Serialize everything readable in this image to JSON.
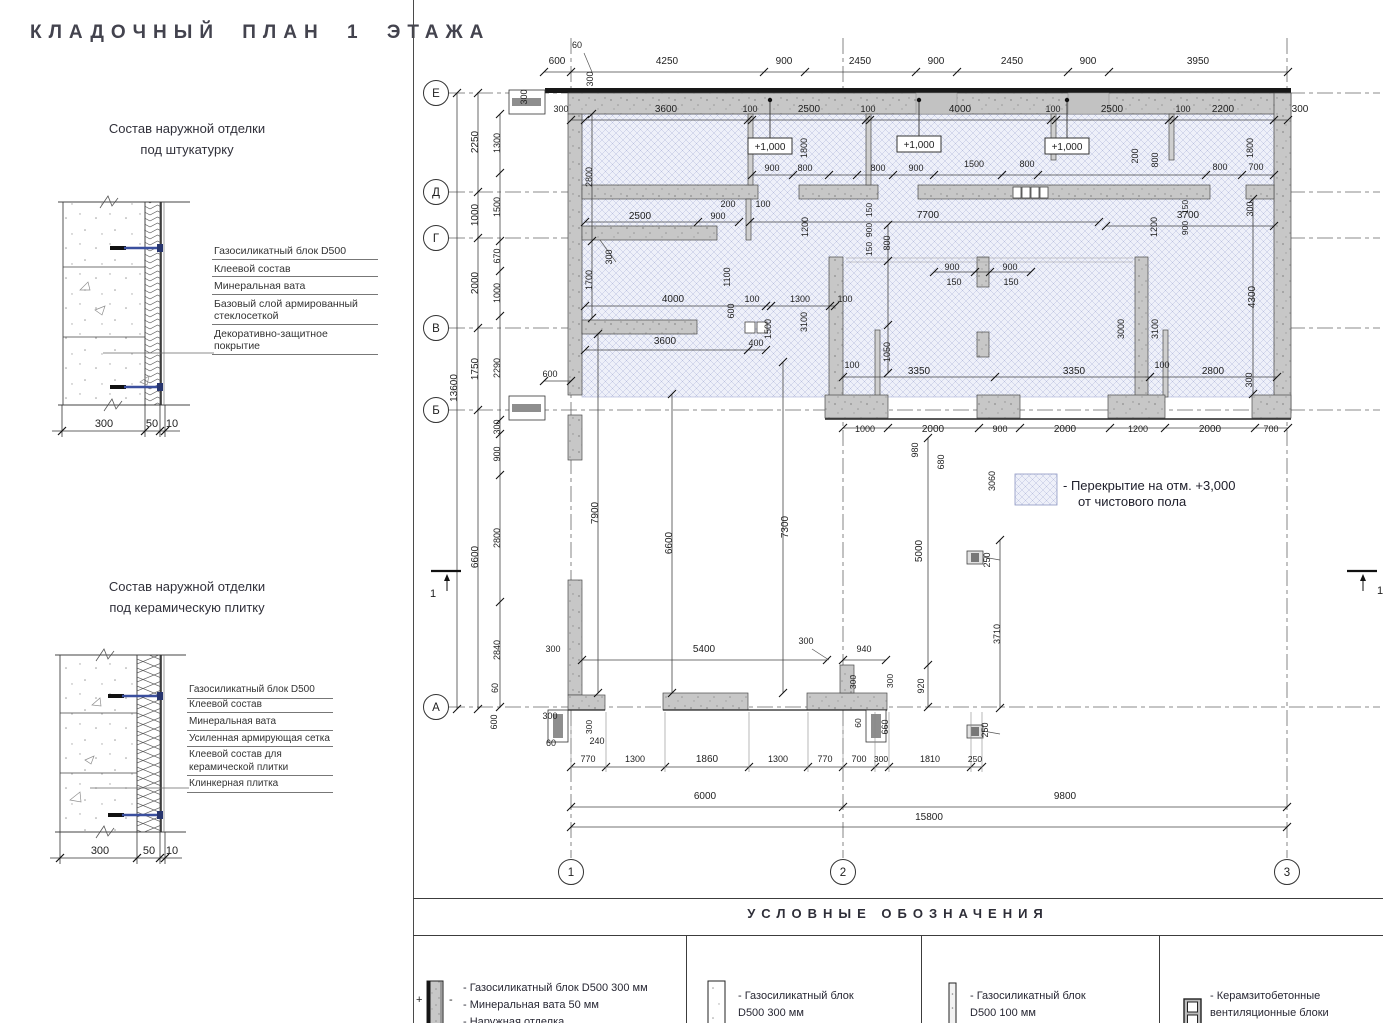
{
  "page": {
    "title": "КЛАДОЧНЫЙ ПЛАН 1 ЭТАЖА"
  },
  "details": [
    {
      "title_line1": "Состав наружной отделки",
      "title_line2": "под штукатурку",
      "labels": [
        "Газосиликатный блок D500",
        "Клеевой состав",
        "Минеральная вата",
        "Базовый слой армированный стеклосеткой",
        "Декоративно-защитное покрытие"
      ],
      "dims": [
        "300",
        "50",
        "10"
      ]
    },
    {
      "title_line1": "Состав наружной отделки",
      "title_line2": "под керамическую плитку",
      "labels": [
        "Газосиликатный блок D500",
        "Клеевой состав",
        "Минеральная вата",
        "Усиленная армирующая сетка",
        "Клеевой состав для керамической плитки",
        "Клинкерная плитка"
      ],
      "dims": [
        "300",
        "50",
        "10"
      ]
    }
  ],
  "plan": {
    "axes": {
      "rows": [
        {
          "label": "Е",
          "y": 93
        },
        {
          "label": "Д",
          "y": 192
        },
        {
          "label": "Г",
          "y": 238
        },
        {
          "label": "В",
          "y": 328
        },
        {
          "label": "Б",
          "y": 410
        },
        {
          "label": "А",
          "y": 707
        }
      ],
      "cols": [
        {
          "label": "1",
          "x": 571
        },
        {
          "label": "2",
          "x": 843
        },
        {
          "label": "3",
          "x": 1287
        }
      ]
    },
    "elevation_markers": [
      {
        "text": "+1,000",
        "x": 748,
        "y": 138
      },
      {
        "text": "+1,000",
        "x": 897,
        "y": 136
      },
      {
        "text": "+1,000",
        "x": 1045,
        "y": 138
      }
    ],
    "section_marks": [
      {
        "label": "1",
        "x": 431,
        "y": 571,
        "lx": 433,
        "ly": 597
      },
      {
        "label": "1",
        "x": 1347,
        "y": 571,
        "lx": 1380,
        "ly": 594
      }
    ],
    "floor_note": {
      "line1": "- Перекрытие на отм. +3,000",
      "line2": "от чистового пола"
    },
    "dim_labels": [
      {
        "t": "600",
        "x": 557,
        "y": 64
      },
      {
        "t": "4250",
        "x": 667,
        "y": 64
      },
      {
        "t": "900",
        "x": 784,
        "y": 64
      },
      {
        "t": "2450",
        "x": 860,
        "y": 64
      },
      {
        "t": "900",
        "x": 936,
        "y": 64
      },
      {
        "t": "2450",
        "x": 1012,
        "y": 64
      },
      {
        "t": "900",
        "x": 1088,
        "y": 64
      },
      {
        "t": "3950",
        "x": 1198,
        "y": 64
      },
      {
        "t": "60",
        "x": 577,
        "y": 48,
        "fs": 9
      },
      {
        "t": "300",
        "x": 561,
        "y": 112,
        "fs": 9
      },
      {
        "t": "3600",
        "x": 666,
        "y": 112
      },
      {
        "t": "100",
        "x": 750,
        "y": 112,
        "fs": 9
      },
      {
        "t": "2500",
        "x": 809,
        "y": 112
      },
      {
        "t": "100",
        "x": 868,
        "y": 112,
        "fs": 9
      },
      {
        "t": "4000",
        "x": 960,
        "y": 112
      },
      {
        "t": "100",
        "x": 1053,
        "y": 112,
        "fs": 9
      },
      {
        "t": "2500",
        "x": 1112,
        "y": 112
      },
      {
        "t": "100",
        "x": 1183,
        "y": 112,
        "fs": 9
      },
      {
        "t": "2200",
        "x": 1223,
        "y": 112
      },
      {
        "t": "300",
        "x": 1300,
        "y": 112
      },
      {
        "t": "300",
        "x": 527,
        "y": 97,
        "r": 1,
        "fs": 9
      },
      {
        "t": "300",
        "x": 593,
        "y": 79,
        "r": 1,
        "fs": 9
      },
      {
        "t": "13600",
        "x": 457,
        "y": 388,
        "r": 1
      },
      {
        "t": "2250",
        "x": 478,
        "y": 142,
        "r": 1
      },
      {
        "t": "1000",
        "x": 478,
        "y": 215,
        "r": 1
      },
      {
        "t": "2000",
        "x": 478,
        "y": 283,
        "r": 1
      },
      {
        "t": "1750",
        "x": 478,
        "y": 369,
        "r": 1
      },
      {
        "t": "6600",
        "x": 478,
        "y": 557,
        "r": 1
      },
      {
        "t": "1300",
        "x": 500,
        "y": 143,
        "r": 1,
        "fs": 9
      },
      {
        "t": "1500",
        "x": 500,
        "y": 207,
        "r": 1,
        "fs": 9
      },
      {
        "t": "670",
        "x": 500,
        "y": 256,
        "r": 1,
        "fs": 9
      },
      {
        "t": "1000",
        "x": 500,
        "y": 293,
        "r": 1,
        "fs": 9
      },
      {
        "t": "2290",
        "x": 500,
        "y": 368,
        "r": 1,
        "fs": 9
      },
      {
        "t": "300",
        "x": 500,
        "y": 427,
        "r": 1,
        "fs": 9
      },
      {
        "t": "900",
        "x": 500,
        "y": 454,
        "r": 1,
        "fs": 9
      },
      {
        "t": "2800",
        "x": 500,
        "y": 538,
        "r": 1,
        "fs": 9
      },
      {
        "t": "2840",
        "x": 500,
        "y": 650,
        "r": 1,
        "fs": 9
      },
      {
        "t": "60",
        "x": 498,
        "y": 688,
        "r": 1,
        "fs": 9
      },
      {
        "t": "600",
        "x": 497,
        "y": 722,
        "r": 1,
        "fs": 9
      },
      {
        "t": "2800",
        "x": 592,
        "y": 177,
        "r": 1,
        "fs": 9
      },
      {
        "t": "1700",
        "x": 592,
        "y": 280,
        "r": 1,
        "fs": 9
      },
      {
        "t": "1800",
        "x": 807,
        "y": 148,
        "r": 1,
        "fs": 9
      },
      {
        "t": "1800",
        "x": 1253,
        "y": 148,
        "r": 1,
        "fs": 9
      },
      {
        "t": "200",
        "x": 1138,
        "y": 156,
        "r": 1,
        "fs": 9
      },
      {
        "t": "800",
        "x": 1158,
        "y": 160,
        "r": 1,
        "fs": 9
      },
      {
        "t": "900",
        "x": 772,
        "y": 171,
        "fs": 9
      },
      {
        "t": "800",
        "x": 805,
        "y": 171,
        "fs": 9
      },
      {
        "t": "800",
        "x": 878,
        "y": 171,
        "fs": 9
      },
      {
        "t": "900",
        "x": 916,
        "y": 171,
        "fs": 9
      },
      {
        "t": "1500",
        "x": 974,
        "y": 167,
        "fs": 9
      },
      {
        "t": "800",
        "x": 1027,
        "y": 167,
        "fs": 9
      },
      {
        "t": "800",
        "x": 1220,
        "y": 170,
        "fs": 9
      },
      {
        "t": "700",
        "x": 1256,
        "y": 170,
        "fs": 9
      },
      {
        "t": "150",
        "x": 872,
        "y": 210,
        "r": 1,
        "fs": 8.5
      },
      {
        "t": "900",
        "x": 872,
        "y": 230,
        "r": 1,
        "fs": 8.5
      },
      {
        "t": "150",
        "x": 872,
        "y": 249,
        "r": 1,
        "fs": 8.5
      },
      {
        "t": "150",
        "x": 1188,
        "y": 207,
        "r": 1,
        "fs": 8.5
      },
      {
        "t": "900",
        "x": 1188,
        "y": 228,
        "r": 1,
        "fs": 8.5
      },
      {
        "t": "200",
        "x": 728,
        "y": 207,
        "fs": 9
      },
      {
        "t": "100",
        "x": 763,
        "y": 207,
        "fs": 9
      },
      {
        "t": "2500",
        "x": 640,
        "y": 219
      },
      {
        "t": "900",
        "x": 718,
        "y": 219,
        "fs": 9
      },
      {
        "t": "7700",
        "x": 928,
        "y": 218
      },
      {
        "t": "3700",
        "x": 1188,
        "y": 218
      },
      {
        "t": "300",
        "x": 1253,
        "y": 209,
        "r": 1,
        "fs": 9
      },
      {
        "t": "1200",
        "x": 1157,
        "y": 227,
        "r": 1,
        "fs": 9
      },
      {
        "t": "1200",
        "x": 808,
        "y": 227,
        "r": 1,
        "fs": 9
      },
      {
        "t": "1100",
        "x": 730,
        "y": 277,
        "r": 1,
        "fs": 9
      },
      {
        "t": "300",
        "x": 612,
        "y": 257,
        "r": 1,
        "fs": 9
      },
      {
        "t": "4000",
        "x": 673,
        "y": 302
      },
      {
        "t": "100",
        "x": 752,
        "y": 302,
        "fs": 9
      },
      {
        "t": "1300",
        "x": 800,
        "y": 302,
        "fs": 9
      },
      {
        "t": "100",
        "x": 845,
        "y": 302,
        "fs": 9
      },
      {
        "t": "600",
        "x": 734,
        "y": 311,
        "r": 1,
        "fs": 9
      },
      {
        "t": "1500",
        "x": 771,
        "y": 329,
        "r": 1,
        "fs": 9
      },
      {
        "t": "3100",
        "x": 807,
        "y": 322,
        "r": 1,
        "fs": 9
      },
      {
        "t": "3600",
        "x": 665,
        "y": 344
      },
      {
        "t": "400",
        "x": 756,
        "y": 346,
        "fs": 9
      },
      {
        "t": "800",
        "x": 890,
        "y": 243,
        "r": 1,
        "fs": 9
      },
      {
        "t": "1050",
        "x": 890,
        "y": 352,
        "r": 1,
        "fs": 9
      },
      {
        "t": "900",
        "x": 952,
        "y": 270,
        "fs": 9
      },
      {
        "t": "900",
        "x": 1010,
        "y": 270,
        "fs": 9
      },
      {
        "t": "150",
        "x": 954,
        "y": 285,
        "fs": 9
      },
      {
        "t": "150",
        "x": 1011,
        "y": 285,
        "fs": 9
      },
      {
        "t": "3000",
        "x": 1124,
        "y": 329,
        "r": 1,
        "fs": 9
      },
      {
        "t": "3100",
        "x": 1158,
        "y": 329,
        "r": 1,
        "fs": 9
      },
      {
        "t": "4300",
        "x": 1255,
        "y": 297,
        "r": 1
      },
      {
        "t": "100",
        "x": 852,
        "y": 368,
        "fs": 9
      },
      {
        "t": "3350",
        "x": 919,
        "y": 374
      },
      {
        "t": "3350",
        "x": 1074,
        "y": 374
      },
      {
        "t": "100",
        "x": 1162,
        "y": 368,
        "fs": 9
      },
      {
        "t": "2800",
        "x": 1213,
        "y": 374
      },
      {
        "t": "300",
        "x": 1252,
        "y": 380,
        "r": 1,
        "fs": 9
      },
      {
        "t": "600",
        "x": 550,
        "y": 377,
        "fs": 9
      },
      {
        "t": "1000",
        "x": 865,
        "y": 432,
        "fs": 9
      },
      {
        "t": "2000",
        "x": 933,
        "y": 432
      },
      {
        "t": "900",
        "x": 1000,
        "y": 432,
        "fs": 9
      },
      {
        "t": "2000",
        "x": 1065,
        "y": 432
      },
      {
        "t": "1200",
        "x": 1138,
        "y": 432,
        "fs": 9
      },
      {
        "t": "2000",
        "x": 1210,
        "y": 432
      },
      {
        "t": "700",
        "x": 1271,
        "y": 432,
        "fs": 9
      },
      {
        "t": "980",
        "x": 918,
        "y": 450,
        "r": 1,
        "fs": 9
      },
      {
        "t": "680",
        "x": 944,
        "y": 462,
        "r": 1,
        "fs": 9
      },
      {
        "t": "3060",
        "x": 995,
        "y": 481,
        "r": 1,
        "fs": 9
      },
      {
        "t": "7900",
        "x": 598,
        "y": 513,
        "r": 1
      },
      {
        "t": "6600",
        "x": 672,
        "y": 543,
        "r": 1
      },
      {
        "t": "7300",
        "x": 788,
        "y": 527,
        "r": 1
      },
      {
        "t": "5000",
        "x": 922,
        "y": 551,
        "r": 1
      },
      {
        "t": "3710",
        "x": 1000,
        "y": 634,
        "r": 1,
        "fs": 9
      },
      {
        "t": "920",
        "x": 924,
        "y": 686,
        "r": 1,
        "fs": 9
      },
      {
        "t": "300",
        "x": 553,
        "y": 652,
        "fs": 9
      },
      {
        "t": "5400",
        "x": 704,
        "y": 652
      },
      {
        "t": "300",
        "x": 806,
        "y": 644,
        "fs": 9
      },
      {
        "t": "940",
        "x": 864,
        "y": 652,
        "fs": 9
      },
      {
        "t": "300",
        "x": 856,
        "y": 682,
        "r": 1,
        "fs": 8.5
      },
      {
        "t": "300",
        "x": 893,
        "y": 681,
        "r": 1,
        "fs": 8.5
      },
      {
        "t": "250",
        "x": 990,
        "y": 560,
        "r": 1,
        "fs": 9
      },
      {
        "t": "250",
        "x": 988,
        "y": 730,
        "r": 1,
        "fs": 9
      },
      {
        "t": "60",
        "x": 861,
        "y": 723,
        "r": 1,
        "fs": 8.5
      },
      {
        "t": "660",
        "x": 888,
        "y": 727,
        "r": 1,
        "fs": 9
      },
      {
        "t": "300",
        "x": 550,
        "y": 719,
        "fs": 9
      },
      {
        "t": "300",
        "x": 592,
        "y": 727,
        "r": 1,
        "fs": 8.5
      },
      {
        "t": "60",
        "x": 551,
        "y": 746,
        "fs": 9
      },
      {
        "t": "240",
        "x": 597,
        "y": 744,
        "fs": 9
      },
      {
        "t": "770",
        "x": 588,
        "y": 762,
        "fs": 9
      },
      {
        "t": "1300",
        "x": 635,
        "y": 762,
        "fs": 9
      },
      {
        "t": "1860",
        "x": 707,
        "y": 762
      },
      {
        "t": "1300",
        "x": 778,
        "y": 762,
        "fs": 9
      },
      {
        "t": "770",
        "x": 825,
        "y": 762,
        "fs": 9
      },
      {
        "t": "700",
        "x": 859,
        "y": 762,
        "fs": 9
      },
      {
        "t": "300",
        "x": 881,
        "y": 762,
        "fs": 8.5
      },
      {
        "t": "1810",
        "x": 930,
        "y": 762,
        "fs": 9
      },
      {
        "t": "250",
        "x": 975,
        "y": 762,
        "fs": 8.5
      },
      {
        "t": "6000",
        "x": 705,
        "y": 799
      },
      {
        "t": "9800",
        "x": 1065,
        "y": 799
      },
      {
        "t": "15800",
        "x": 929,
        "y": 820
      }
    ]
  },
  "legend": {
    "title": "УСЛОВНЫЕ ОБОЗНАЧЕНИЯ",
    "items": [
      {
        "plus": "+",
        "minus": "-",
        "lines": [
          "- Газосиликатный блок D500 300 мм",
          "- Минеральная вата 50 мм",
          "- Наружная отделка"
        ]
      },
      {
        "lines": [
          "- Газосиликатный блок",
          "D500 300 мм"
        ]
      },
      {
        "lines": [
          "- Газосиликатный блок",
          "D500 100 мм"
        ]
      },
      {
        "lines": [
          "- Керамзитобетонные",
          "вентиляционные блоки"
        ]
      }
    ]
  }
}
